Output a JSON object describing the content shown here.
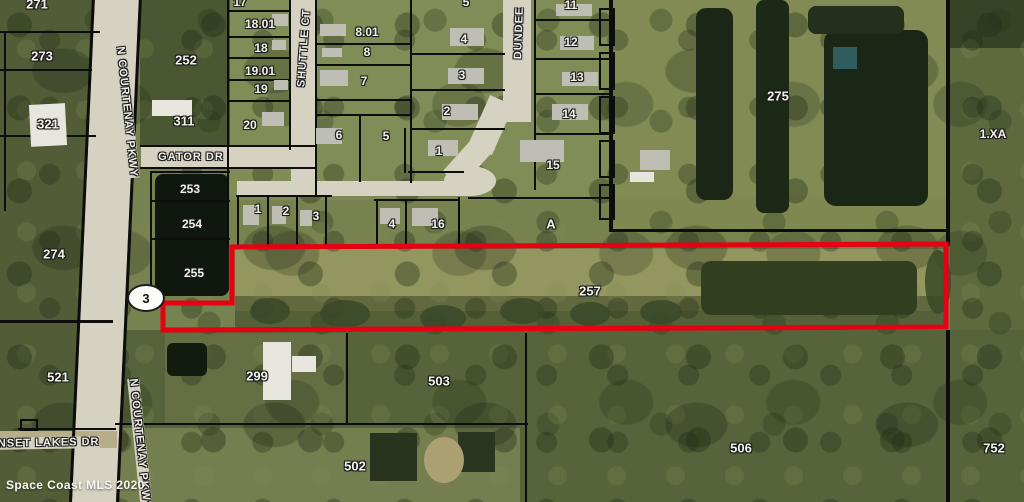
{
  "map": {
    "watermark": "Space Coast MLS 2020",
    "shield": {
      "route": "3"
    },
    "subject_parcel": {
      "label": "257",
      "outline_color": "#e60012"
    },
    "labels": [
      {
        "text": "271",
        "x": 37,
        "y": 4,
        "size": 13,
        "kind": "parcel"
      },
      {
        "text": "273",
        "x": 42,
        "y": 56,
        "size": 13,
        "kind": "parcel"
      },
      {
        "text": "321",
        "x": 48,
        "y": 124,
        "size": 13,
        "kind": "parcel"
      },
      {
        "text": "274",
        "x": 54,
        "y": 254,
        "size": 13,
        "kind": "parcel"
      },
      {
        "text": "521",
        "x": 58,
        "y": 377,
        "size": 13,
        "kind": "parcel"
      },
      {
        "text": "252",
        "x": 186,
        "y": 60,
        "size": 13,
        "kind": "parcel"
      },
      {
        "text": "311",
        "x": 184,
        "y": 121,
        "size": 13,
        "kind": "parcel"
      },
      {
        "text": "253",
        "x": 190,
        "y": 189,
        "size": 12,
        "kind": "parcel"
      },
      {
        "text": "254",
        "x": 192,
        "y": 224,
        "size": 12,
        "kind": "parcel"
      },
      {
        "text": "255",
        "x": 194,
        "y": 273,
        "size": 12,
        "kind": "parcel"
      },
      {
        "text": "257",
        "x": 590,
        "y": 291,
        "size": 13,
        "kind": "parcel"
      },
      {
        "text": "17",
        "x": 240,
        "y": 2,
        "size": 12,
        "kind": "parcel"
      },
      {
        "text": "18.01",
        "x": 260,
        "y": 24,
        "size": 12,
        "kind": "parcel"
      },
      {
        "text": "18",
        "x": 261,
        "y": 48,
        "size": 12,
        "kind": "parcel"
      },
      {
        "text": "19.01",
        "x": 260,
        "y": 71,
        "size": 12,
        "kind": "parcel"
      },
      {
        "text": "19",
        "x": 261,
        "y": 89,
        "size": 12,
        "kind": "parcel"
      },
      {
        "text": "20",
        "x": 250,
        "y": 125,
        "size": 12,
        "kind": "parcel"
      },
      {
        "text": "8.01",
        "x": 367,
        "y": 32,
        "size": 12,
        "kind": "parcel"
      },
      {
        "text": "8",
        "x": 367,
        "y": 52,
        "size": 12,
        "kind": "parcel"
      },
      {
        "text": "7",
        "x": 364,
        "y": 81,
        "size": 12,
        "kind": "parcel"
      },
      {
        "text": "6",
        "x": 339,
        "y": 135,
        "size": 12,
        "kind": "parcel"
      },
      {
        "text": "5",
        "x": 386,
        "y": 136,
        "size": 12,
        "kind": "parcel"
      },
      {
        "text": "5",
        "x": 466,
        "y": 2,
        "size": 12,
        "kind": "parcel"
      },
      {
        "text": "4",
        "x": 464,
        "y": 39,
        "size": 12,
        "kind": "parcel"
      },
      {
        "text": "3",
        "x": 462,
        "y": 75,
        "size": 12,
        "kind": "parcel"
      },
      {
        "text": "2",
        "x": 447,
        "y": 111,
        "size": 12,
        "kind": "parcel"
      },
      {
        "text": "1",
        "x": 439,
        "y": 151,
        "size": 12,
        "kind": "parcel"
      },
      {
        "text": "11",
        "x": 571,
        "y": 5,
        "size": 12,
        "kind": "parcel"
      },
      {
        "text": "12",
        "x": 571,
        "y": 42,
        "size": 12,
        "kind": "parcel"
      },
      {
        "text": "13",
        "x": 577,
        "y": 77,
        "size": 12,
        "kind": "parcel"
      },
      {
        "text": "14",
        "x": 569,
        "y": 114,
        "size": 12,
        "kind": "parcel"
      },
      {
        "text": "15",
        "x": 553,
        "y": 165,
        "size": 12,
        "kind": "parcel"
      },
      {
        "text": "1",
        "x": 258,
        "y": 209,
        "size": 12,
        "kind": "parcel"
      },
      {
        "text": "2",
        "x": 286,
        "y": 211,
        "size": 12,
        "kind": "parcel"
      },
      {
        "text": "3",
        "x": 316,
        "y": 216,
        "size": 12,
        "kind": "parcel"
      },
      {
        "text": "4",
        "x": 392,
        "y": 224,
        "size": 12,
        "kind": "parcel"
      },
      {
        "text": "16",
        "x": 438,
        "y": 224,
        "size": 12,
        "kind": "parcel"
      },
      {
        "text": "A",
        "x": 551,
        "y": 224,
        "size": 13,
        "kind": "parcel"
      },
      {
        "text": "275",
        "x": 778,
        "y": 96,
        "size": 13,
        "kind": "parcel"
      },
      {
        "text": "1.XA",
        "x": 993,
        "y": 134,
        "size": 12,
        "kind": "parcel"
      },
      {
        "text": "299",
        "x": 257,
        "y": 376,
        "size": 13,
        "kind": "parcel"
      },
      {
        "text": "503",
        "x": 439,
        "y": 381,
        "size": 13,
        "kind": "parcel"
      },
      {
        "text": "502",
        "x": 355,
        "y": 466,
        "size": 13,
        "kind": "parcel"
      },
      {
        "text": "506",
        "x": 741,
        "y": 448,
        "size": 13,
        "kind": "parcel"
      },
      {
        "text": "752",
        "x": 994,
        "y": 448,
        "size": 13,
        "kind": "parcel"
      },
      {
        "text": "N COURTENAY PKWY",
        "x": 127,
        "y": 112,
        "rot": 84,
        "kind": "road"
      },
      {
        "text": "N COURTENAY PKWY",
        "x": 140,
        "y": 444,
        "rot": 84,
        "kind": "road"
      },
      {
        "text": "GATOR DR",
        "x": 191,
        "y": 157,
        "rot": 0,
        "kind": "road"
      },
      {
        "text": "SHUTTLE CT",
        "x": 304,
        "y": 48,
        "rot": -86,
        "kind": "road"
      },
      {
        "text": "DUNDEE",
        "x": 519,
        "y": 33,
        "rot": -88,
        "kind": "road"
      },
      {
        "text": "SUNSET LAKES DR",
        "x": 40,
        "y": 443,
        "rot": -1,
        "kind": "road"
      }
    ],
    "colors": {
      "subject_outline": "#e60012",
      "parcel_line": "#0d0d0d",
      "road_surface": "#d5d2c2",
      "water": "#1b2616",
      "label_text": "#f2f1ea"
    }
  }
}
